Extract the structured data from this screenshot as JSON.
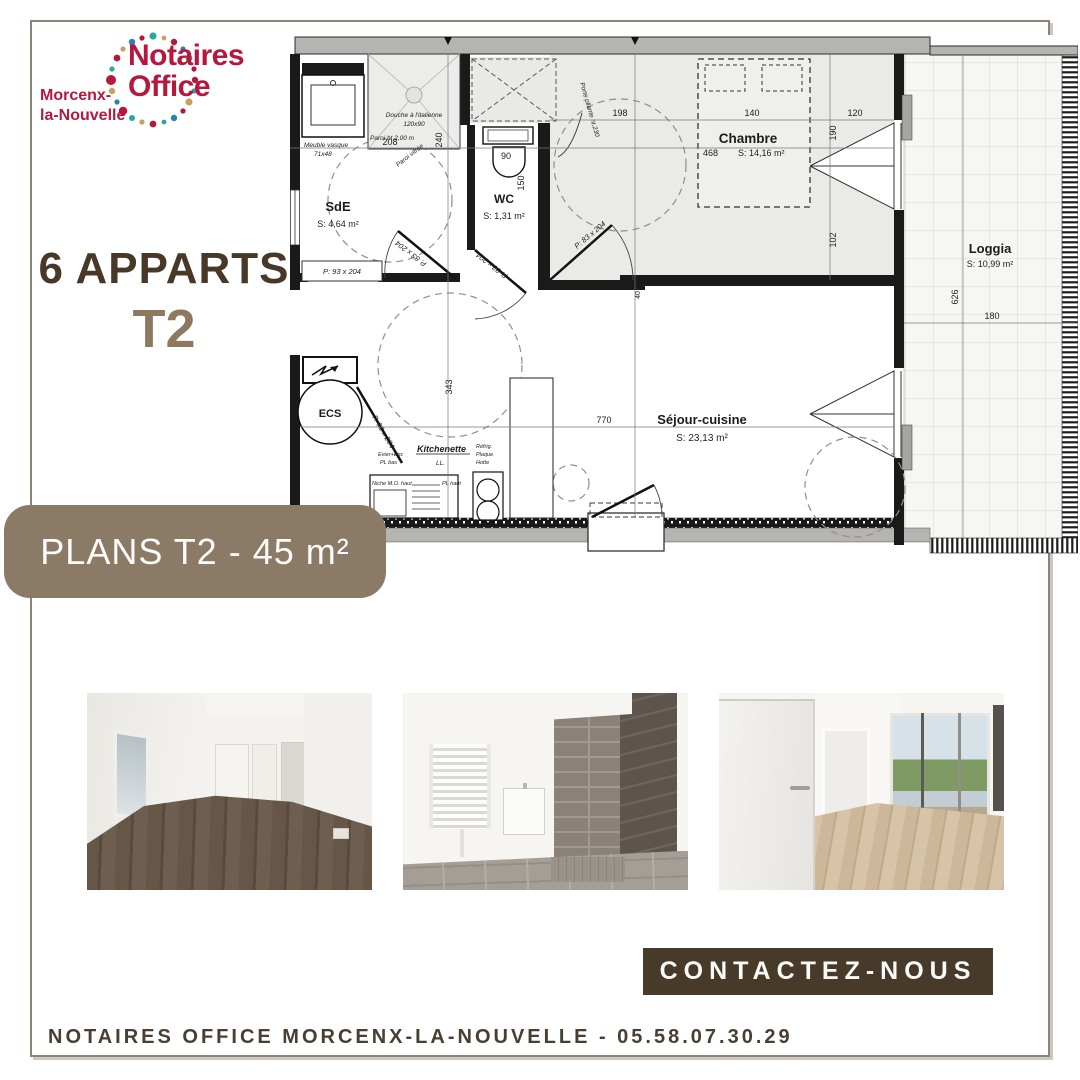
{
  "page": {
    "background": "#ffffff",
    "frame_color": "#8d8476"
  },
  "logo": {
    "brand_line1": "Notaires",
    "brand_line2": "Office",
    "location_line1": "Morcenx-",
    "location_line2": "la-Nouvelle",
    "brand_color": "#b5173d",
    "dot_colors": [
      "#b5173d",
      "#2aa79e",
      "#c9a15f",
      "#2e7fb8"
    ]
  },
  "headline": {
    "count_label": "6 APPARTS",
    "type_label": "T2"
  },
  "banner": {
    "label": "PLANS T2 - 45 m²",
    "background": "#8a7a66"
  },
  "floorplan": {
    "rooms": {
      "sde": {
        "name": "SdE",
        "area": "S: 4,64 m²"
      },
      "wc": {
        "name": "WC",
        "area": "S: 1,31 m²"
      },
      "chambre": {
        "name": "Chambre",
        "area": "S: 14,16 m²"
      },
      "loggia": {
        "name": "Loggia",
        "area": "S: 10,99 m²"
      },
      "sejour": {
        "name": "Séjour-cuisine",
        "area": "S: 23,13 m²"
      },
      "kitchenette": "Kitchenette",
      "ecs": "ECS"
    },
    "fixtures": {
      "douche_line1": "Douche à l'italienne",
      "douche_line2": "120x90",
      "vasque_line1": "Meuble vasque",
      "vasque_line2": "71x48",
      "paroi": "Paroi ht 2,00 m",
      "paroi_vitree": "Paroi vitrée",
      "porte_pliante": "Porte pliante ht.230",
      "lave_linge": "LL.",
      "refrig": "Réfrig.",
      "plaque": "Plaque",
      "hotte": "Hotte",
      "evier": "Evier+Egc",
      "pl_bas": "PL bas",
      "niche": "Niche M.O. haut",
      "pl_haut": "PL haut"
    },
    "doors": {
      "sde_box": "P: 93 x 204",
      "sde": "P. 83 x 204",
      "wc": "P. 83 x 204",
      "chambre": "P: 83 x 204",
      "ecs": "P. 93 x 204"
    },
    "dims": {
      "d208": "208",
      "d240": "240",
      "d90": "90",
      "d150": "150",
      "d198": "198",
      "d140": "140",
      "d120": "120",
      "d190": "190",
      "d102": "102",
      "d468": "468",
      "d626": "626",
      "d180": "180",
      "d770": "770",
      "d343": "343",
      "d40": "40"
    }
  },
  "photos": [
    {
      "id": "empty-room",
      "description": "Pièce vide, murs blancs, sol stratifié foncé"
    },
    {
      "id": "bathroom",
      "description": "Salle d'eau carrelée avec douche à l'italienne et sèche-serviettes"
    },
    {
      "id": "living-room",
      "description": "Séjour lumineux avec baie vitrée donnant sur la loggia"
    }
  ],
  "cta": {
    "label": "CONTACTEZ-NOUS",
    "background": "#483a29"
  },
  "footer": {
    "text": "NOTAIRES OFFICE MORCENX-LA-NOUVELLE - 05.58.07.30.29"
  }
}
